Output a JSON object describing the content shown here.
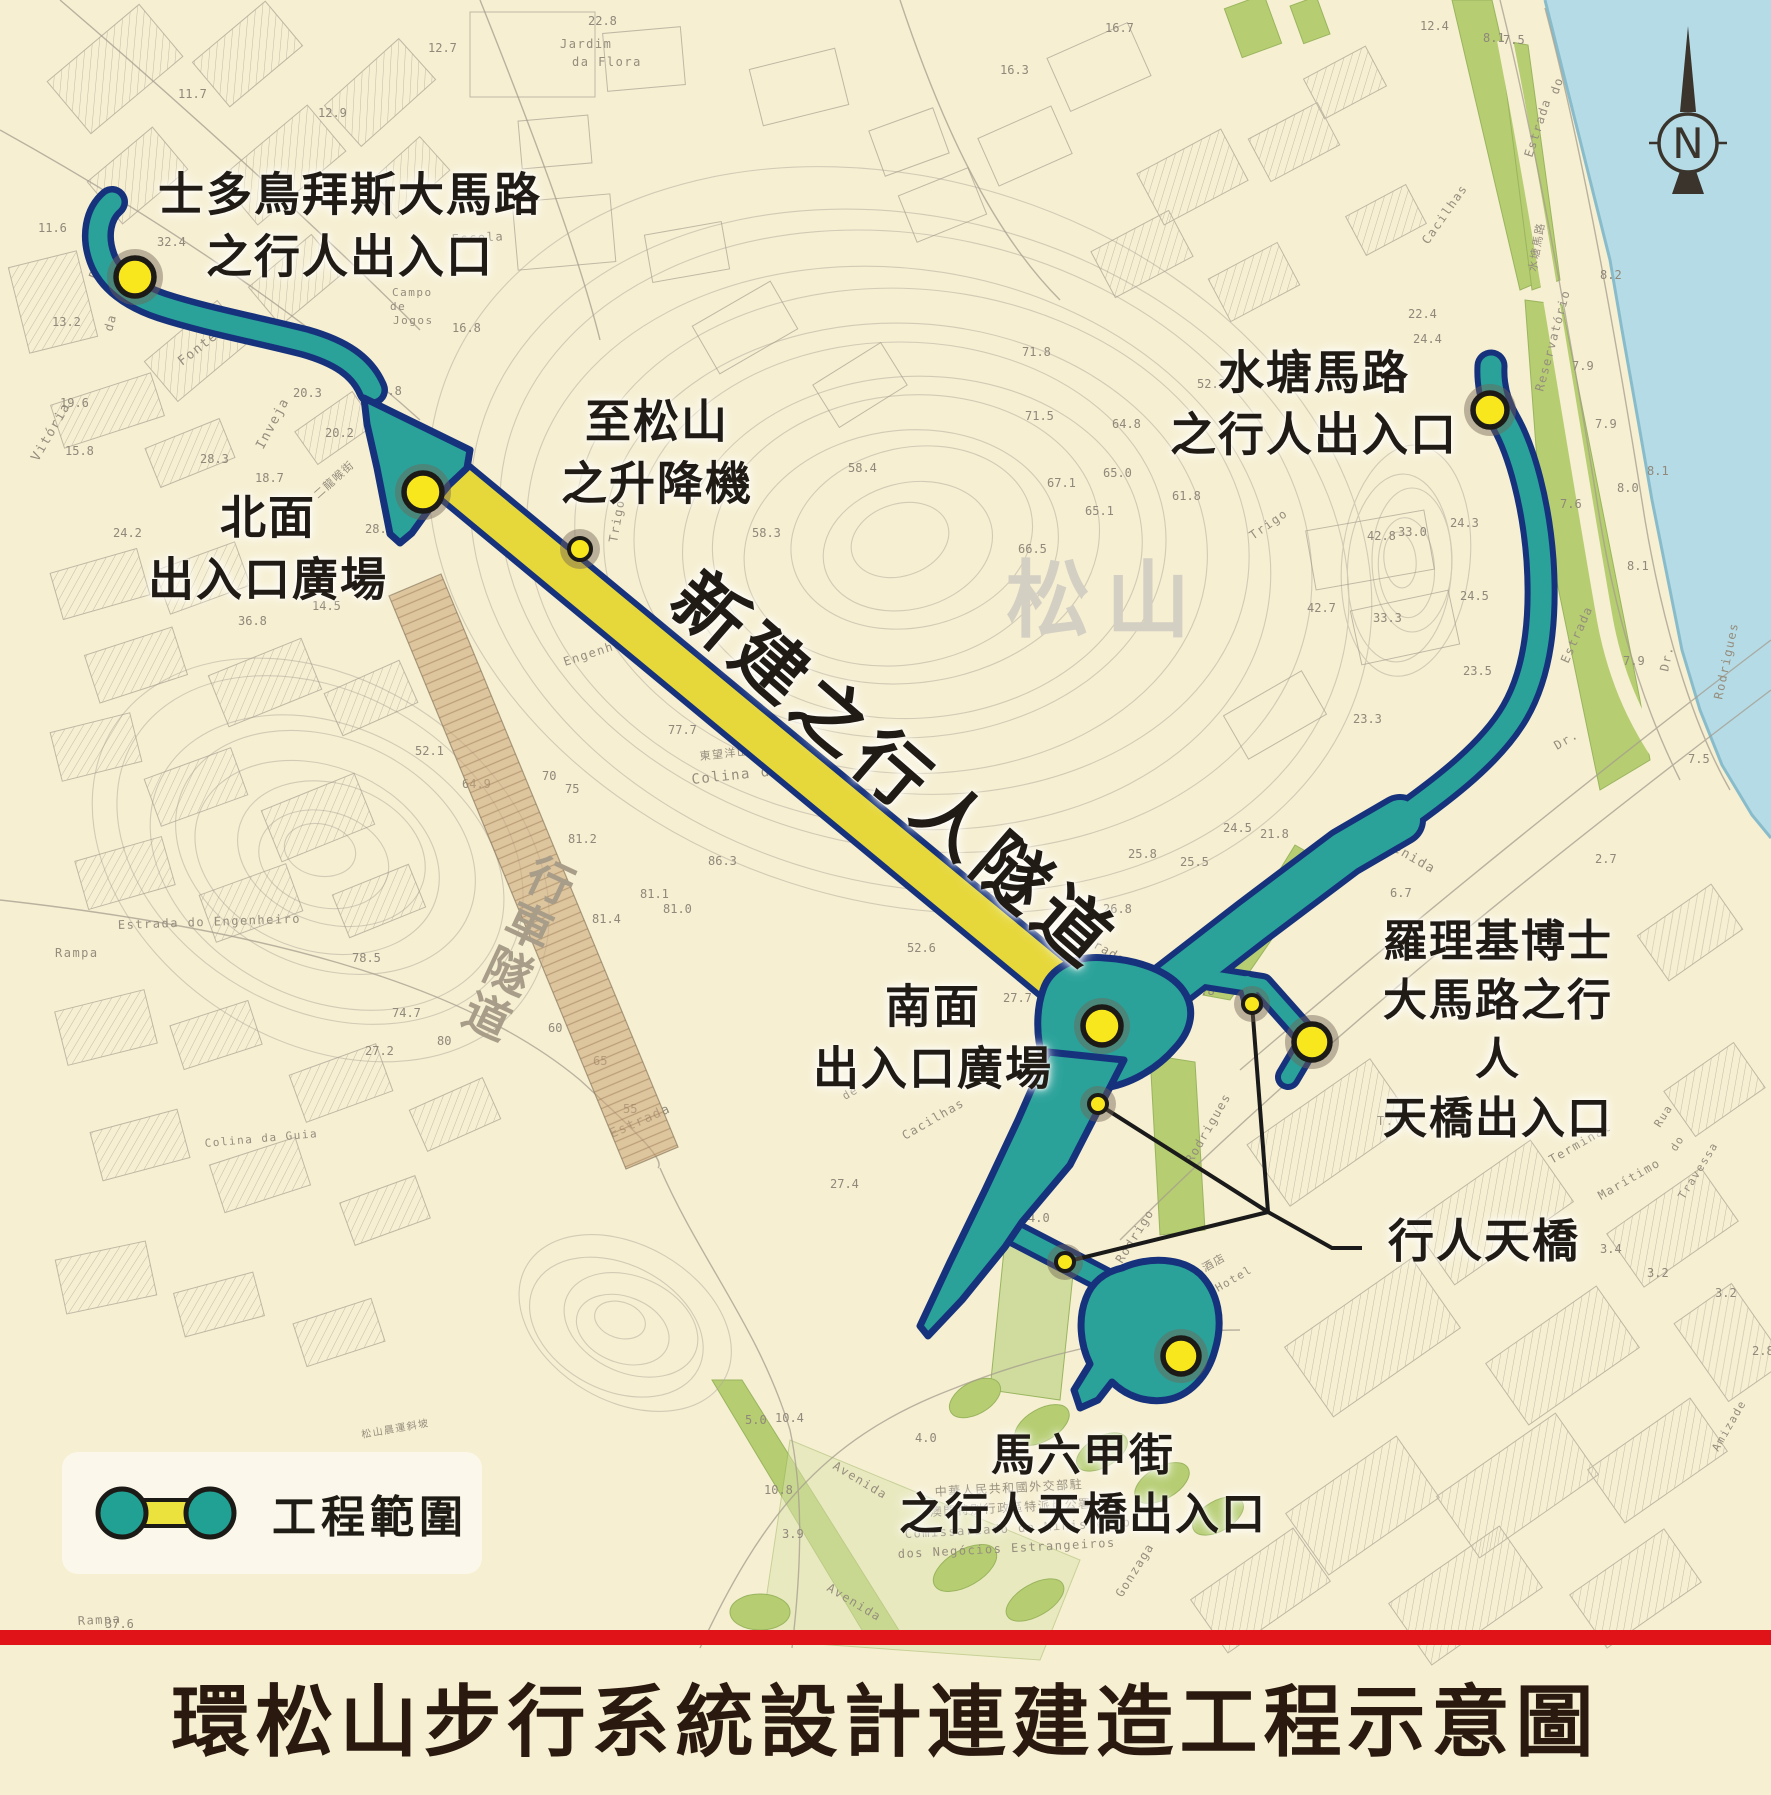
{
  "title": "環松山步行系統設計連建造工程示意圖",
  "legend": {
    "label": "工程範圍",
    "icon": "project-scope-dumbbell-icon"
  },
  "compass": {
    "label": "N"
  },
  "colors": {
    "paper": "#f6efd2",
    "water": "#b5dbe6",
    "green": "#b6cd72",
    "green_light": "#cfdc9e",
    "teal": "#2aa29a",
    "navy": "#16327c",
    "tunnel_yellow": "#e6d83b",
    "marker_yellow": "#f8e71c",
    "vehicle_tunnel_tan": "#cda97c",
    "red_bar": "#e01418",
    "contour_gray": "#b4ac9d",
    "title_color": "#2a190f"
  },
  "map": {
    "labels": [
      {
        "name": "entrance-sidonio-pais",
        "text": "士多鳥拜斯大馬路\n之行人出入口",
        "x": 350,
        "y": 226,
        "size": 46
      },
      {
        "name": "north-plaza",
        "text": "北面\n出入口廣場",
        "x": 268,
        "y": 549,
        "size": 46
      },
      {
        "name": "elevator-to-guia",
        "text": "至松山\n之升降機",
        "x": 657,
        "y": 453,
        "size": 46
      },
      {
        "name": "reservoir-road-entrance",
        "text": "水塘馬路\n之行人出入口",
        "x": 1314,
        "y": 404,
        "size": 46
      },
      {
        "name": "south-plaza",
        "text": "南面\n出入口廣場",
        "x": 933,
        "y": 1038,
        "size": 46
      },
      {
        "name": "rodrigues-entrance",
        "text": "羅理基博士\n大馬路之行人\n天橋出入口",
        "x": 1498,
        "y": 1031,
        "size": 44
      },
      {
        "name": "footbridge",
        "text": "行人天橋",
        "x": 1484,
        "y": 1242,
        "size": 46
      },
      {
        "name": "malacca-entrance",
        "text": "馬六甲街\n之行人天橋出入口",
        "x": 1083,
        "y": 1486,
        "size": 44
      },
      {
        "name": "pedestrian-tunnel",
        "text": "新建之行人隧道",
        "x": 893,
        "y": 772,
        "size": 72,
        "rot": 41,
        "cls": "tunnel-name"
      },
      {
        "name": "guia-hill",
        "text": "松山",
        "x": 1106,
        "y": 601,
        "size": 84,
        "color": "#d3cfc3",
        "cls": "hill-name"
      },
      {
        "name": "vehicle-tunnel",
        "text": "行車隧道",
        "x": 515,
        "y": 948,
        "size": 46,
        "color": "#a89d89",
        "rot": 25,
        "vertical": true,
        "cls": "veh-tunnel"
      }
    ],
    "street_names": [
      {
        "t": "Jardim",
        "x": 560,
        "y": 48,
        "r": 0,
        "s": 12
      },
      {
        "t": "da Flora",
        "x": 572,
        "y": 66,
        "r": 0,
        "s": 12
      },
      {
        "t": "Escola",
        "x": 452,
        "y": 243,
        "r": -3,
        "s": 12
      },
      {
        "t": "Campo",
        "x": 392,
        "y": 296,
        "r": 0,
        "s": 11
      },
      {
        "t": "de",
        "x": 390,
        "y": 310,
        "r": 0,
        "s": 11
      },
      {
        "t": "Jogos",
        "x": 393,
        "y": 324,
        "r": 0,
        "s": 11
      },
      {
        "t": "Rua",
        "x": 97,
        "y": 280,
        "r": -68,
        "s": 13
      },
      {
        "t": "da",
        "x": 112,
        "y": 332,
        "r": -75,
        "s": 12
      },
      {
        "t": "Fonte",
        "x": 182,
        "y": 366,
        "r": -38,
        "s": 13
      },
      {
        "t": "Inveja",
        "x": 263,
        "y": 450,
        "r": -62,
        "s": 13
      },
      {
        "t": "Vitória",
        "x": 38,
        "y": 462,
        "r": -60,
        "s": 13
      },
      {
        "t": "二龍喉街",
        "x": 318,
        "y": 499,
        "r": -42,
        "s": 11
      },
      {
        "t": "Trigo",
        "x": 617,
        "y": 543,
        "r": -80,
        "s": 12
      },
      {
        "t": "Trigo",
        "x": 1253,
        "y": 540,
        "r": -35,
        "s": 12
      },
      {
        "t": "東望洋山",
        "x": 700,
        "y": 760,
        "r": -6,
        "s": 11
      },
      {
        "t": "Colina da Guia",
        "x": 692,
        "y": 784,
        "r": -6,
        "s": 14
      },
      {
        "t": "Colina da Guia",
        "x": 205,
        "y": 1147,
        "r": -5,
        "s": 11
      },
      {
        "t": "Engenheiro",
        "x": 565,
        "y": 666,
        "r": -18,
        "s": 12
      },
      {
        "t": "Estrada",
        "x": 612,
        "y": 1138,
        "r": -24,
        "s": 13
      },
      {
        "t": "Estrada  do  Engenheiro",
        "x": 118,
        "y": 929,
        "r": -2,
        "s": 12
      },
      {
        "t": "Rampa",
        "x": 55,
        "y": 957,
        "r": 0,
        "s": 12
      },
      {
        "t": "Cacilhas",
        "x": 905,
        "y": 1140,
        "r": -30,
        "s": 12
      },
      {
        "t": "de",
        "x": 845,
        "y": 1100,
        "r": -30,
        "s": 11
      },
      {
        "t": "Estrada",
        "x": 1070,
        "y": 934,
        "r": 30,
        "s": 12
      },
      {
        "t": "Estrada",
        "x": 1532,
        "y": 158,
        "r": -72,
        "s": 12
      },
      {
        "t": "do",
        "x": 1558,
        "y": 95,
        "r": -72,
        "s": 12
      },
      {
        "t": "Cacilhas",
        "x": 1428,
        "y": 245,
        "r": -55,
        "s": 12
      },
      {
        "t": "水塘馬路",
        "x": 1536,
        "y": 272,
        "r": -80,
        "s": 11
      },
      {
        "t": "Reservatório",
        "x": 1543,
        "y": 392,
        "r": -75,
        "s": 12
      },
      {
        "t": "Estrada",
        "x": 1568,
        "y": 664,
        "r": -66,
        "s": 12
      },
      {
        "t": "Dr.",
        "x": 1557,
        "y": 750,
        "r": -30,
        "s": 12
      },
      {
        "t": "Dr.",
        "x": 1668,
        "y": 672,
        "r": -78,
        "s": 12
      },
      {
        "t": "Rodrigo",
        "x": 1122,
        "y": 1264,
        "r": -58,
        "s": 12
      },
      {
        "t": "Rodrigues",
        "x": 1192,
        "y": 1164,
        "r": -60,
        "s": 12
      },
      {
        "t": "Rodrigues",
        "x": 1722,
        "y": 700,
        "r": -78,
        "s": 12
      },
      {
        "t": "Avenida",
        "x": 1376,
        "y": 841,
        "r": 30,
        "s": 13
      },
      {
        "t": "Avenida",
        "x": 832,
        "y": 1468,
        "r": 31,
        "s": 12
      },
      {
        "t": "Avenida",
        "x": 826,
        "y": 1590,
        "r": 31,
        "s": 12
      },
      {
        "t": "Terminal",
        "x": 1552,
        "y": 1164,
        "r": -30,
        "s": 12
      },
      {
        "t": "Marítimo",
        "x": 1601,
        "y": 1200,
        "r": -30,
        "s": 12
      },
      {
        "t": "Travessa",
        "x": 1684,
        "y": 1200,
        "r": -58,
        "s": 11
      },
      {
        "t": "Rua",
        "x": 1660,
        "y": 1128,
        "r": -58,
        "s": 11
      },
      {
        "t": "do",
        "x": 1676,
        "y": 1152,
        "r": -58,
        "s": 11
      },
      {
        "t": "Gonzaga",
        "x": 1122,
        "y": 1598,
        "r": -58,
        "s": 12
      },
      {
        "t": "Amizade",
        "x": 1718,
        "y": 1452,
        "r": -60,
        "s": 11
      },
      {
        "t": "酒店",
        "x": 1205,
        "y": 1272,
        "r": -30,
        "s": 11
      },
      {
        "t": "Hotel",
        "x": 1218,
        "y": 1292,
        "r": -30,
        "s": 11
      },
      {
        "t": "T.V.",
        "x": 1377,
        "y": 1125,
        "r": 0,
        "s": 12
      },
      {
        "t": "中華人民共和國外交部駐",
        "x": 935,
        "y": 1496,
        "r": -3,
        "s": 12
      },
      {
        "t": "澳門特別行政區特派員公署",
        "x": 930,
        "y": 1516,
        "r": -3,
        "s": 12
      },
      {
        "t": "Comissariado  do  Ministério",
        "x": 905,
        "y": 1538,
        "r": -3,
        "s": 12
      },
      {
        "t": "dos  Negócios  Estrangeiros",
        "x": 898,
        "y": 1558,
        "r": -3,
        "s": 12
      },
      {
        "t": "松山晨運斜坡",
        "x": 362,
        "y": 1438,
        "r": -10,
        "s": 10
      },
      {
        "t": "Rampa",
        "x": 78,
        "y": 1625,
        "r": -3,
        "s": 12
      }
    ],
    "elevations": [
      {
        "v": "11.7",
        "x": 178,
        "y": 98
      },
      {
        "v": "12.9",
        "x": 318,
        "y": 117
      },
      {
        "v": "12.7",
        "x": 428,
        "y": 52
      },
      {
        "v": "22.8",
        "x": 588,
        "y": 25
      },
      {
        "v": "11.6",
        "x": 38,
        "y": 232
      },
      {
        "v": "13.2",
        "x": 52,
        "y": 326
      },
      {
        "v": "32.4",
        "x": 157,
        "y": 246
      },
      {
        "v": "16.8",
        "x": 452,
        "y": 332
      },
      {
        "v": "20.3",
        "x": 293,
        "y": 397
      },
      {
        "v": "22.8",
        "x": 373,
        "y": 395
      },
      {
        "v": "20.2",
        "x": 325,
        "y": 437
      },
      {
        "v": "19.6",
        "x": 60,
        "y": 407
      },
      {
        "v": "15.8",
        "x": 65,
        "y": 455
      },
      {
        "v": "24.2",
        "x": 113,
        "y": 537
      },
      {
        "v": "28.3",
        "x": 200,
        "y": 463
      },
      {
        "v": "18.7",
        "x": 255,
        "y": 482
      },
      {
        "v": "36.8",
        "x": 238,
        "y": 625
      },
      {
        "v": "28.2",
        "x": 365,
        "y": 533
      },
      {
        "v": "14.5",
        "x": 312,
        "y": 610
      },
      {
        "v": "12.4",
        "x": 1420,
        "y": 30
      },
      {
        "v": "8.1",
        "x": 1483,
        "y": 42
      },
      {
        "v": "7.5",
        "x": 1503,
        "y": 44
      },
      {
        "v": "16.7",
        "x": 1105,
        "y": 32
      },
      {
        "v": "16.3",
        "x": 1000,
        "y": 74
      },
      {
        "v": "22.4",
        "x": 1408,
        "y": 318
      },
      {
        "v": "24.4",
        "x": 1413,
        "y": 343
      },
      {
        "v": "71.8",
        "x": 1022,
        "y": 356
      },
      {
        "v": "71.5",
        "x": 1025,
        "y": 420
      },
      {
        "v": "64.8",
        "x": 1112,
        "y": 428
      },
      {
        "v": "52.2",
        "x": 1197,
        "y": 388
      },
      {
        "v": "65.0",
        "x": 1103,
        "y": 477
      },
      {
        "v": "67.1",
        "x": 1047,
        "y": 487
      },
      {
        "v": "66.5",
        "x": 1018,
        "y": 553
      },
      {
        "v": "65.1",
        "x": 1085,
        "y": 515
      },
      {
        "v": "61.8",
        "x": 1172,
        "y": 500
      },
      {
        "v": "58.3",
        "x": 752,
        "y": 537
      },
      {
        "v": "58.4",
        "x": 848,
        "y": 472
      },
      {
        "v": "64.9",
        "x": 462,
        "y": 788
      },
      {
        "v": "77.7",
        "x": 668,
        "y": 734
      },
      {
        "v": "81.2",
        "x": 568,
        "y": 843
      },
      {
        "v": "81.4",
        "x": 592,
        "y": 923
      },
      {
        "v": "81.1",
        "x": 640,
        "y": 898
      },
      {
        "v": "86.3",
        "x": 708,
        "y": 865
      },
      {
        "v": "81.0",
        "x": 663,
        "y": 913
      },
      {
        "v": "78.5",
        "x": 352,
        "y": 962
      },
      {
        "v": "75",
        "x": 565,
        "y": 793
      },
      {
        "v": "70",
        "x": 542,
        "y": 780
      },
      {
        "v": "80",
        "x": 437,
        "y": 1045
      },
      {
        "v": "74.7",
        "x": 392,
        "y": 1017
      },
      {
        "v": "65",
        "x": 593,
        "y": 1065
      },
      {
        "v": "60",
        "x": 548,
        "y": 1032
      },
      {
        "v": "55",
        "x": 623,
        "y": 1113
      },
      {
        "v": "52.1",
        "x": 415,
        "y": 755
      },
      {
        "v": "52.6",
        "x": 907,
        "y": 952
      },
      {
        "v": "27.7",
        "x": 1003,
        "y": 1002
      },
      {
        "v": "26.8",
        "x": 1103,
        "y": 913
      },
      {
        "v": "25.8",
        "x": 1128,
        "y": 858
      },
      {
        "v": "25.5",
        "x": 1180,
        "y": 866
      },
      {
        "v": "27.3",
        "x": 1052,
        "y": 946
      },
      {
        "v": "27.4",
        "x": 830,
        "y": 1188
      },
      {
        "v": "27.2",
        "x": 365,
        "y": 1055
      },
      {
        "v": "4.8",
        "x": 1193,
        "y": 995
      },
      {
        "v": "4.0",
        "x": 915,
        "y": 1442
      },
      {
        "v": "4.3",
        "x": 998,
        "y": 1450
      },
      {
        "v": "3.9",
        "x": 782,
        "y": 1538
      },
      {
        "v": "5.0",
        "x": 745,
        "y": 1424
      },
      {
        "v": "10.4",
        "x": 775,
        "y": 1422
      },
      {
        "v": "10.8",
        "x": 764,
        "y": 1494
      },
      {
        "v": "3.4",
        "x": 1600,
        "y": 1253
      },
      {
        "v": "3.2",
        "x": 1647,
        "y": 1277
      },
      {
        "v": "3.2",
        "x": 1715,
        "y": 1297
      },
      {
        "v": "2.8",
        "x": 1752,
        "y": 1355
      },
      {
        "v": "2.7",
        "x": 1595,
        "y": 863
      },
      {
        "v": "7.9",
        "x": 1572,
        "y": 370
      },
      {
        "v": "7.9",
        "x": 1595,
        "y": 428
      },
      {
        "v": "8.0",
        "x": 1617,
        "y": 492
      },
      {
        "v": "8.1",
        "x": 1647,
        "y": 475
      },
      {
        "v": "8.1",
        "x": 1627,
        "y": 570
      },
      {
        "v": "7.9",
        "x": 1623,
        "y": 665
      },
      {
        "v": "7.6",
        "x": 1560,
        "y": 508
      },
      {
        "v": "7.5",
        "x": 1688,
        "y": 763
      },
      {
        "v": "8.2",
        "x": 1600,
        "y": 279
      },
      {
        "v": "23.5",
        "x": 1463,
        "y": 675
      },
      {
        "v": "24.5",
        "x": 1460,
        "y": 600
      },
      {
        "v": "24.3",
        "x": 1450,
        "y": 527
      },
      {
        "v": "33.3",
        "x": 1373,
        "y": 622
      },
      {
        "v": "33.0",
        "x": 1398,
        "y": 536
      },
      {
        "v": "42.8",
        "x": 1367,
        "y": 540
      },
      {
        "v": "42.7",
        "x": 1307,
        "y": 612
      },
      {
        "v": "23.3",
        "x": 1353,
        "y": 723
      },
      {
        "v": "21.8",
        "x": 1260,
        "y": 838
      },
      {
        "v": "24.5",
        "x": 1223,
        "y": 832
      },
      {
        "v": "4.0",
        "x": 1028,
        "y": 1222
      },
      {
        "v": "6.7",
        "x": 1390,
        "y": 897
      },
      {
        "v": "4.5",
        "x": 1308,
        "y": 897
      },
      {
        "v": "37.6",
        "x": 105,
        "y": 1628
      }
    ],
    "markers": [
      {
        "name": "sidonio-pais-entrance",
        "x": 135,
        "y": 277,
        "r": 19
      },
      {
        "name": "north-plaza",
        "x": 423,
        "y": 492,
        "r": 19
      },
      {
        "name": "elevator-to-guia",
        "x": 580,
        "y": 549,
        "r": 11
      },
      {
        "name": "reservoir-road-entrance",
        "x": 1490,
        "y": 410,
        "r": 17
      },
      {
        "name": "south-plaza",
        "x": 1102,
        "y": 1026,
        "r": 19
      },
      {
        "name": "footbridge-node-upper",
        "x": 1252,
        "y": 1004,
        "r": 9
      },
      {
        "name": "rodrigues-entrance",
        "x": 1312,
        "y": 1042,
        "r": 18
      },
      {
        "name": "footbridge-node-mid",
        "x": 1098,
        "y": 1104,
        "r": 9
      },
      {
        "name": "footbridge-node-lower",
        "x": 1065,
        "y": 1262,
        "r": 9
      },
      {
        "name": "malacca-entrance",
        "x": 1181,
        "y": 1356,
        "r": 18
      }
    ]
  }
}
